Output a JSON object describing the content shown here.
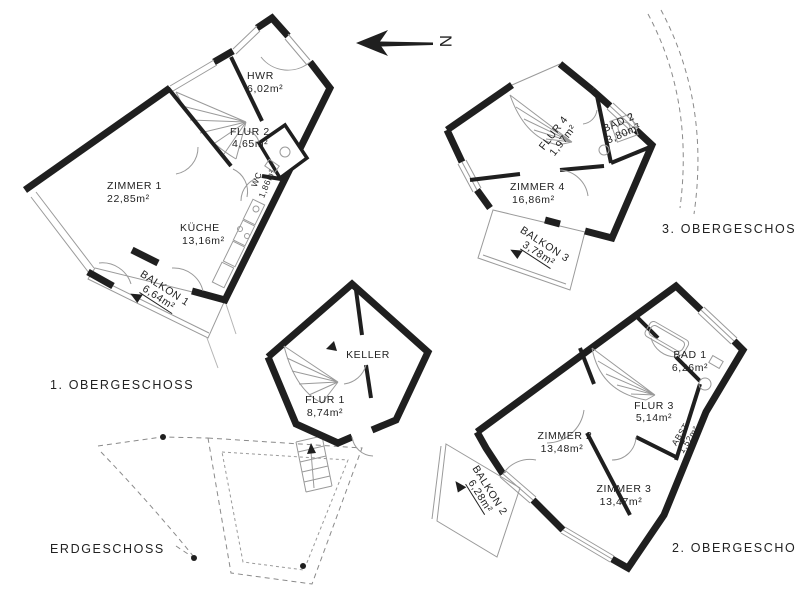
{
  "drawing": {
    "north_label": "N",
    "floors": [
      {
        "label": "1. OBERGESCHOSS",
        "rooms": [
          {
            "name": "HWR",
            "area": "6,02m²"
          },
          {
            "name": "FLUR 2",
            "area": "4,65m²"
          },
          {
            "name": "WC",
            "area": "1,86m²"
          },
          {
            "name": "ZIMMER 1",
            "area": "22,85m²"
          },
          {
            "name": "KÜCHE",
            "area": "13,16m²"
          },
          {
            "name": "BALKON 1",
            "area": "6,64m²"
          }
        ]
      },
      {
        "label": "ERDGESCHOSS",
        "rooms": [
          {
            "name": "KELLER",
            "area": ""
          },
          {
            "name": "FLUR 1",
            "area": "8,74m²"
          }
        ]
      },
      {
        "label": "2. OBERGESCHOSS",
        "rooms": [
          {
            "name": "BAD 1",
            "area": "6,26m²"
          },
          {
            "name": "FLUR 3",
            "area": "5,14m²"
          },
          {
            "name": "ZIMMER 2",
            "area": "13,48m²"
          },
          {
            "name": "ZIMMER 3",
            "area": "13,47m²"
          },
          {
            "name": "ABST",
            "area": "1,52m²"
          },
          {
            "name": "BALKON 2",
            "area": "6,28m²"
          }
        ]
      },
      {
        "label": "3. OBERGESCHOSS",
        "rooms": [
          {
            "name": "FLUR 4",
            "area": "1,97m²"
          },
          {
            "name": "BAD 2",
            "area": "3,80m²"
          },
          {
            "name": "ZIMMER 4",
            "area": "16,86m²"
          },
          {
            "name": "BALKON 3",
            "area": "3,78m²"
          }
        ]
      }
    ]
  }
}
